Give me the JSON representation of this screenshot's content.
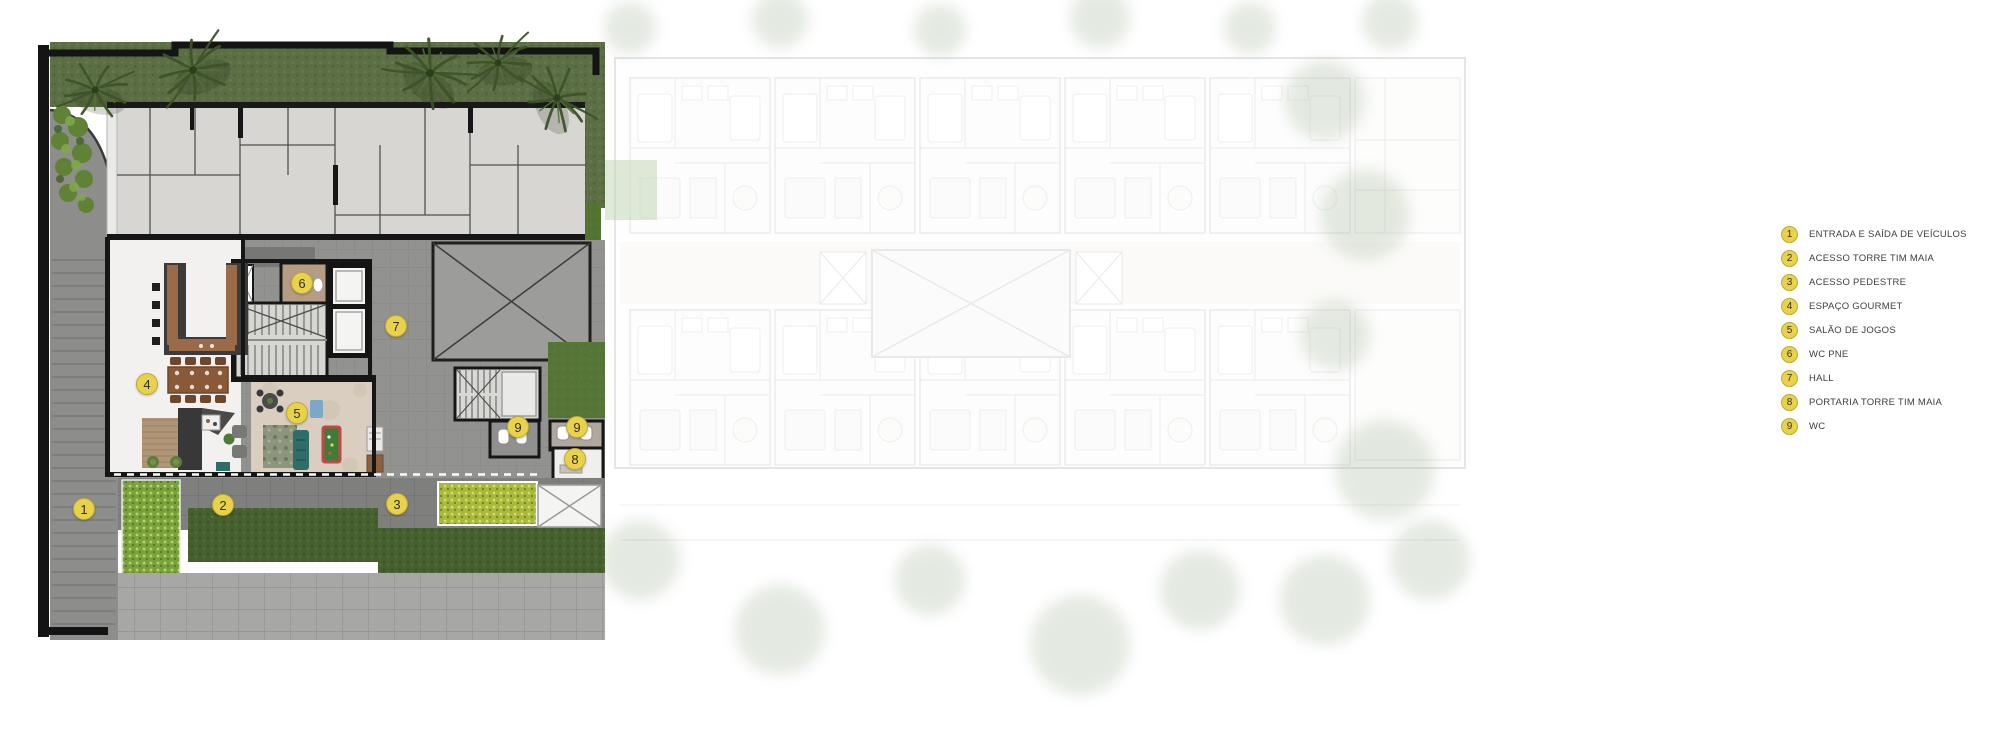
{
  "legend": {
    "items": [
      {
        "num": "1",
        "label": "ENTRADA E SAÍDA DE VEÍCULOS"
      },
      {
        "num": "2",
        "label": "ACESSO TORRE TIM MAIA"
      },
      {
        "num": "3",
        "label": "ACESSO PEDESTRE"
      },
      {
        "num": "4",
        "label": "ESPAÇO GOURMET"
      },
      {
        "num": "5",
        "label": "SALÃO DE JOGOS"
      },
      {
        "num": "6",
        "label": "WC PNE"
      },
      {
        "num": "7",
        "label": "HALL"
      },
      {
        "num": "8",
        "label": "PORTARIA TORRE TIM MAIA"
      },
      {
        "num": "9",
        "label": "WC"
      }
    ]
  },
  "plan": {
    "markers": [
      {
        "num": "1"
      },
      {
        "num": "2"
      },
      {
        "num": "3"
      },
      {
        "num": "4"
      },
      {
        "num": "5"
      },
      {
        "num": "6"
      },
      {
        "num": "7"
      },
      {
        "num": "9"
      },
      {
        "num": "9"
      },
      {
        "num": "8"
      }
    ]
  },
  "colors": {
    "marker_fill": "#e8d14b",
    "marker_border": "#bfab33",
    "marker_text": "#2f2f2f",
    "legend_text": "#3e3e3e",
    "lawn_green": "#5c6e44",
    "hedge_bright": "#7aa23c",
    "hedge_dark": "#47602f",
    "hedge_yellow": "#a9b93f",
    "driveway_gray": "#8d8d8b",
    "pavement_gray": "#a7a7a5",
    "hall_gray": "#929290",
    "plate_gray": "#d7d6d2",
    "gourmet_floor": "#f2f1ef",
    "games_floor": "#d9cec0",
    "wall_black": "#161616",
    "pool_table_green": "#3e7d35",
    "sofa_teal": "#2f6d68"
  }
}
